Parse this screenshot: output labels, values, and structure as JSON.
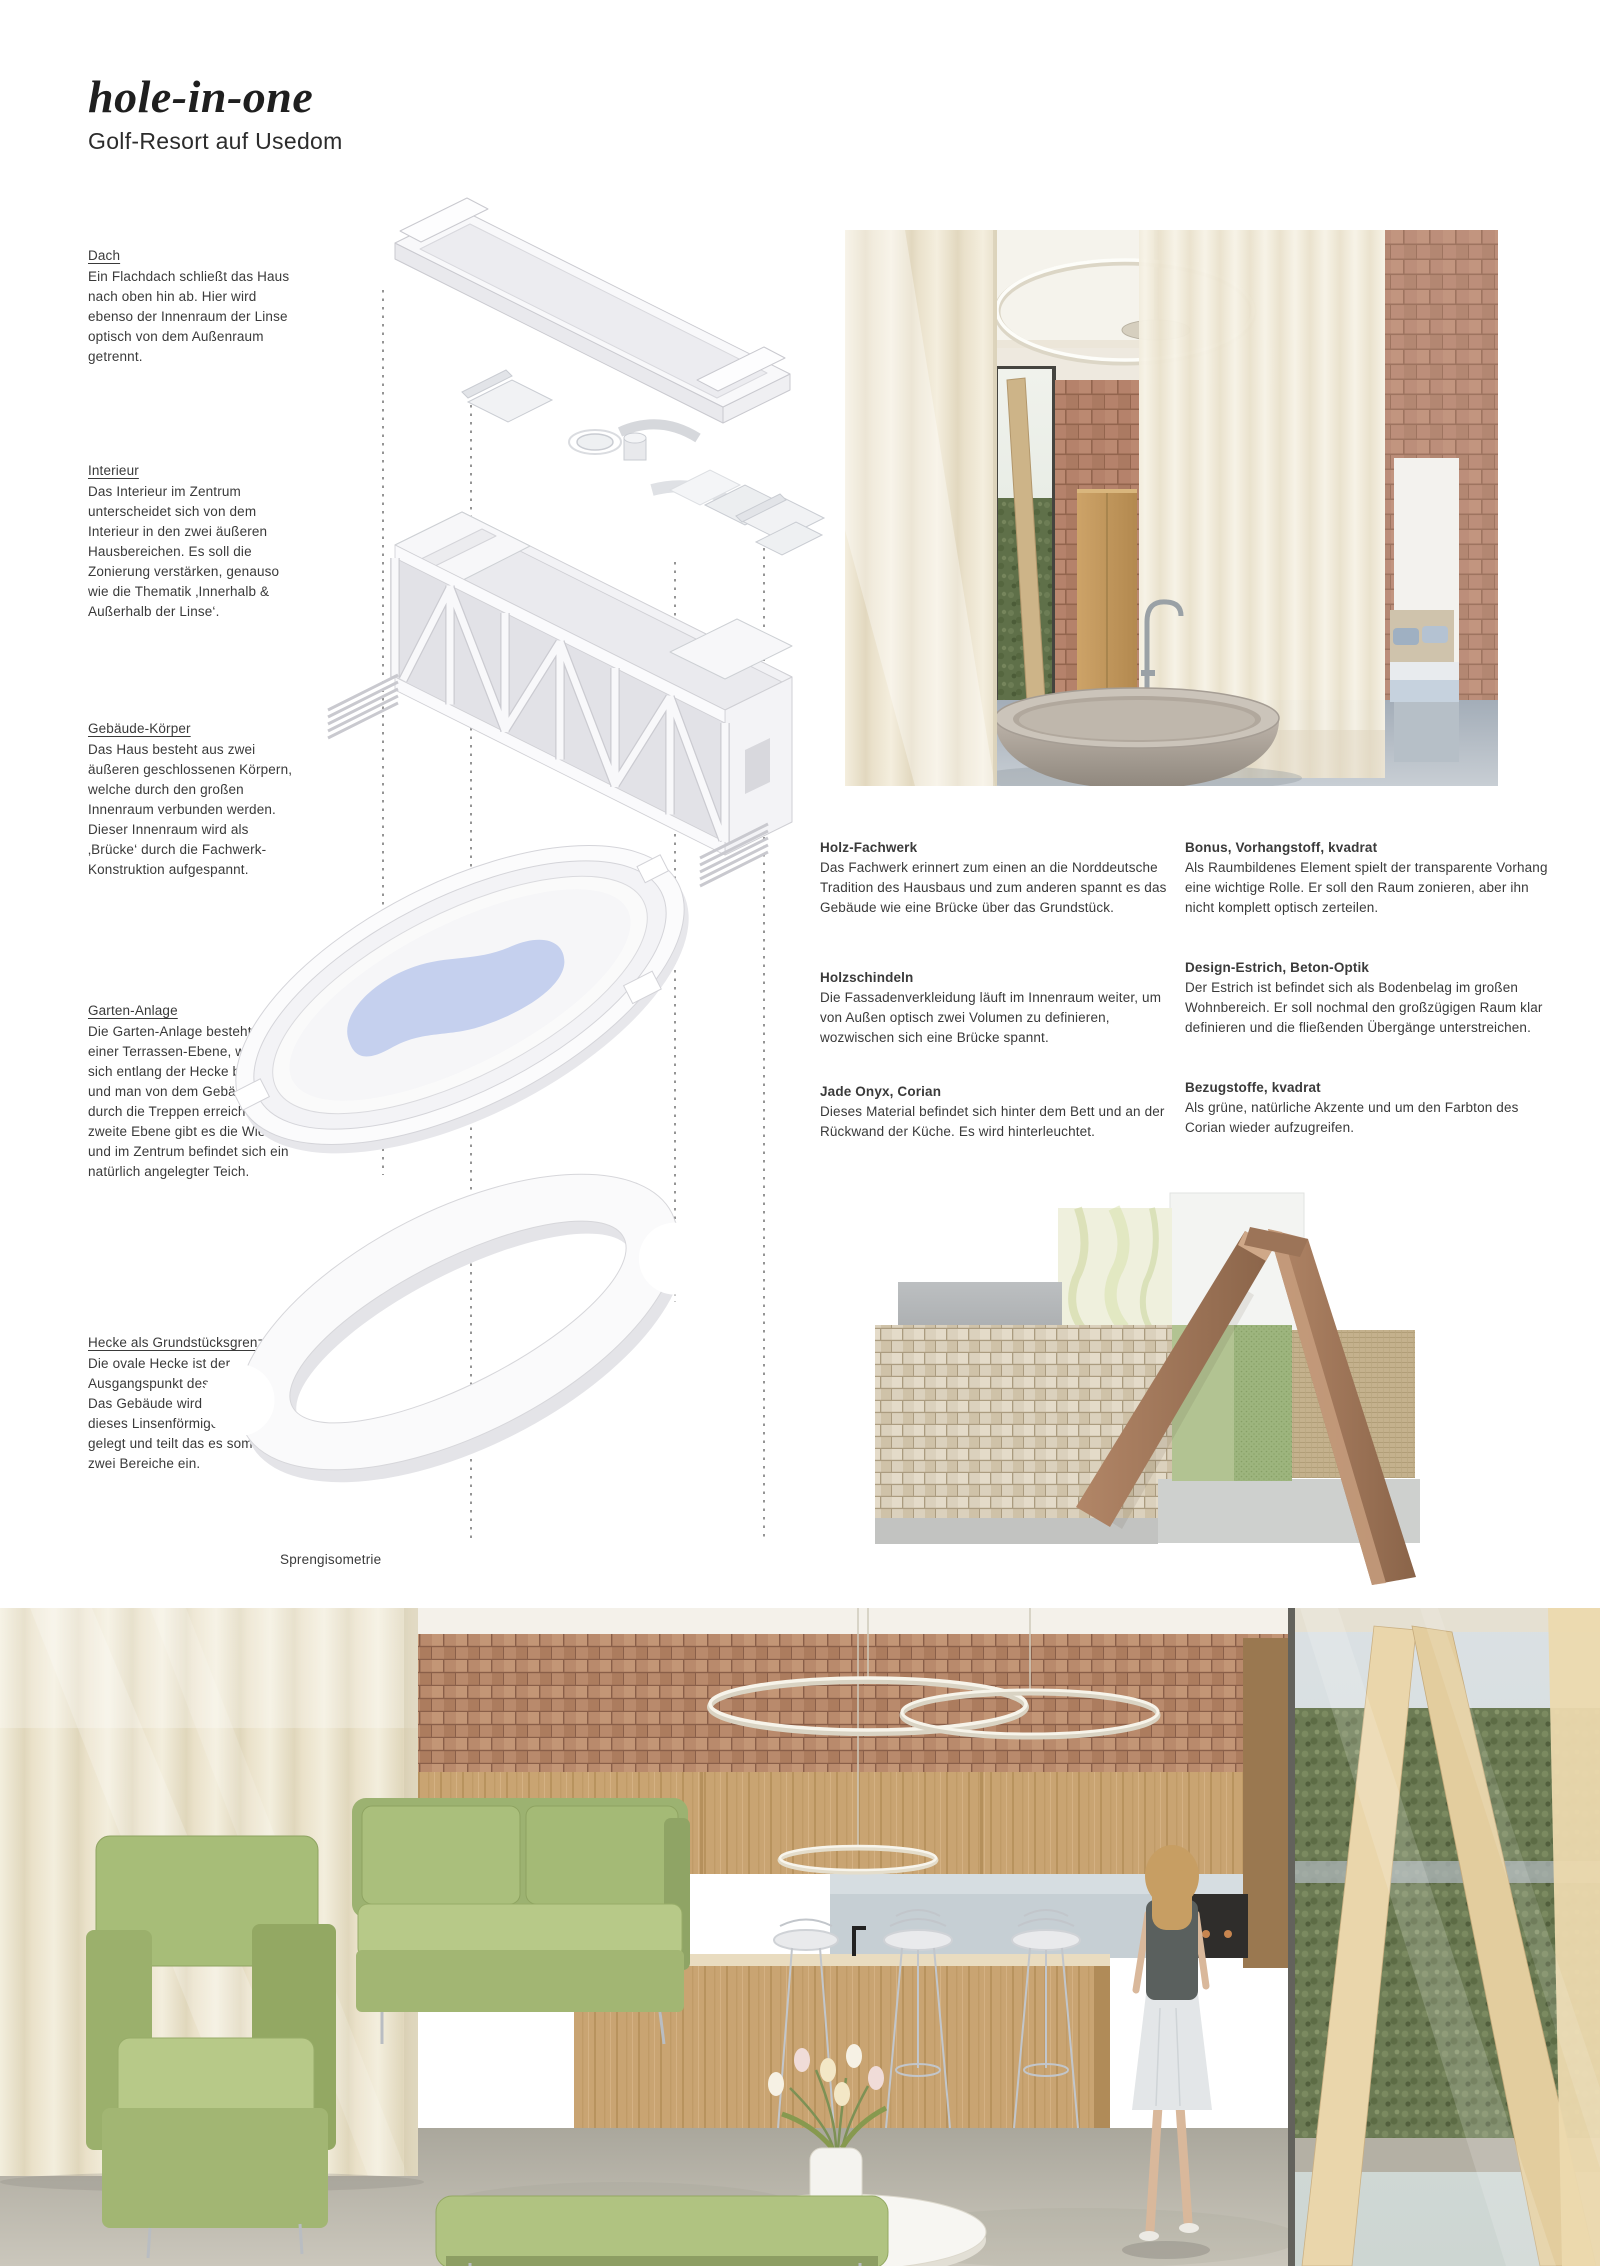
{
  "header": {
    "title": "hole-in-one",
    "subtitle": "Golf-Resort auf Usedom"
  },
  "left_column": {
    "blocks": [
      {
        "heading": "Dach",
        "body": "Ein Flachdach schließt das Haus nach oben hin ab. Hier wird ebenso der Innenraum der Linse optisch von dem Außenraum getrennt."
      },
      {
        "heading": "Interieur",
        "body": "Das Interieur im Zentrum unterscheidet sich von dem Interieur in den zwei äußeren Hausbereichen. Es soll die Zonierung verstärken, genauso wie die Thematik ‚Innerhalb & Außerhalb der Linse‘."
      },
      {
        "heading": "Gebäude-Körper",
        "body": "Das Haus besteht aus zwei äußeren geschlossenen Körpern, welche durch den großen Innenraum verbunden werden. Dieser Innenraum wird als ‚Brücke‘ durch die Fachwerk-Konstruktion aufgespannt."
      },
      {
        "heading": "Garten-Anlage",
        "body": "Die Garten-Anlage besteht aus einer Terrassen-Ebene, welche sich entlang der Hecke befindet und man von dem Gebäude durch die Treppen erreicht. Als zweite Ebene gibt es die Wiese und im Zentrum befindet sich ein natürlich angelegter Teich."
      },
      {
        "heading": "Hecke als Grundstücksgrenze",
        "body": "Die ovale Hecke ist der Ausgangspunkt des Entwurfs. Das Gebäude wird einmal über dieses Linsenförmige Grundstück gelegt und teilt das es somit in zwei Bereiche ein."
      }
    ]
  },
  "isometric": {
    "caption": "Sprengisometrie"
  },
  "materials": {
    "col1": [
      {
        "heading": "Holz-Fachwerk",
        "body": "Das Fachwerk erinnert zum einen an die Norddeutsche Tradition des Hausbaus und zum anderen spannt es das Gebäude wie eine Brücke über das Grundstück."
      },
      {
        "heading": "Holzschindeln",
        "body": "Die Fassadenverkleidung läuft im Innenraum weiter, um von Außen optisch zwei Volumen zu definieren, wozwischen sich eine Brücke spannt."
      },
      {
        "heading": "Jade Onyx, Corian",
        "body": "Dieses Material befindet sich hinter dem Bett und an der Rückwand der Küche. Es wird hinterleuchtet."
      }
    ],
    "col2": [
      {
        "heading": "Bonus, Vorhangstoff, kvadrat",
        "body": "Als Raumbildenes Element spielt der transparente Vorhang eine wichtige Rolle. Er soll den Raum zonieren, aber ihn nicht komplett optisch zerteilen."
      },
      {
        "heading": "Design-Estrich, Beton-Optik",
        "body": "Der Estrich ist befindet sich als Bodenbelag im großen Wohnbereich. Er soll nochmal den großzügigen Raum klar definieren und die fließenden Übergänge unterstreichen."
      },
      {
        "heading": "Bezugstoffe, kvadrat",
        "body": "Als grüne, natürliche Akzente und um den Farbton des Corian wieder aufzugreifen."
      }
    ]
  },
  "colors": {
    "sofa_green": "#a9bf7a",
    "pond_blue": "#c5d0ee",
    "wood": "#c9a671",
    "brick_shingle": "#b5826b",
    "curtain_cream": "#efe8d8",
    "concrete_floor": "#b5b2a9"
  }
}
